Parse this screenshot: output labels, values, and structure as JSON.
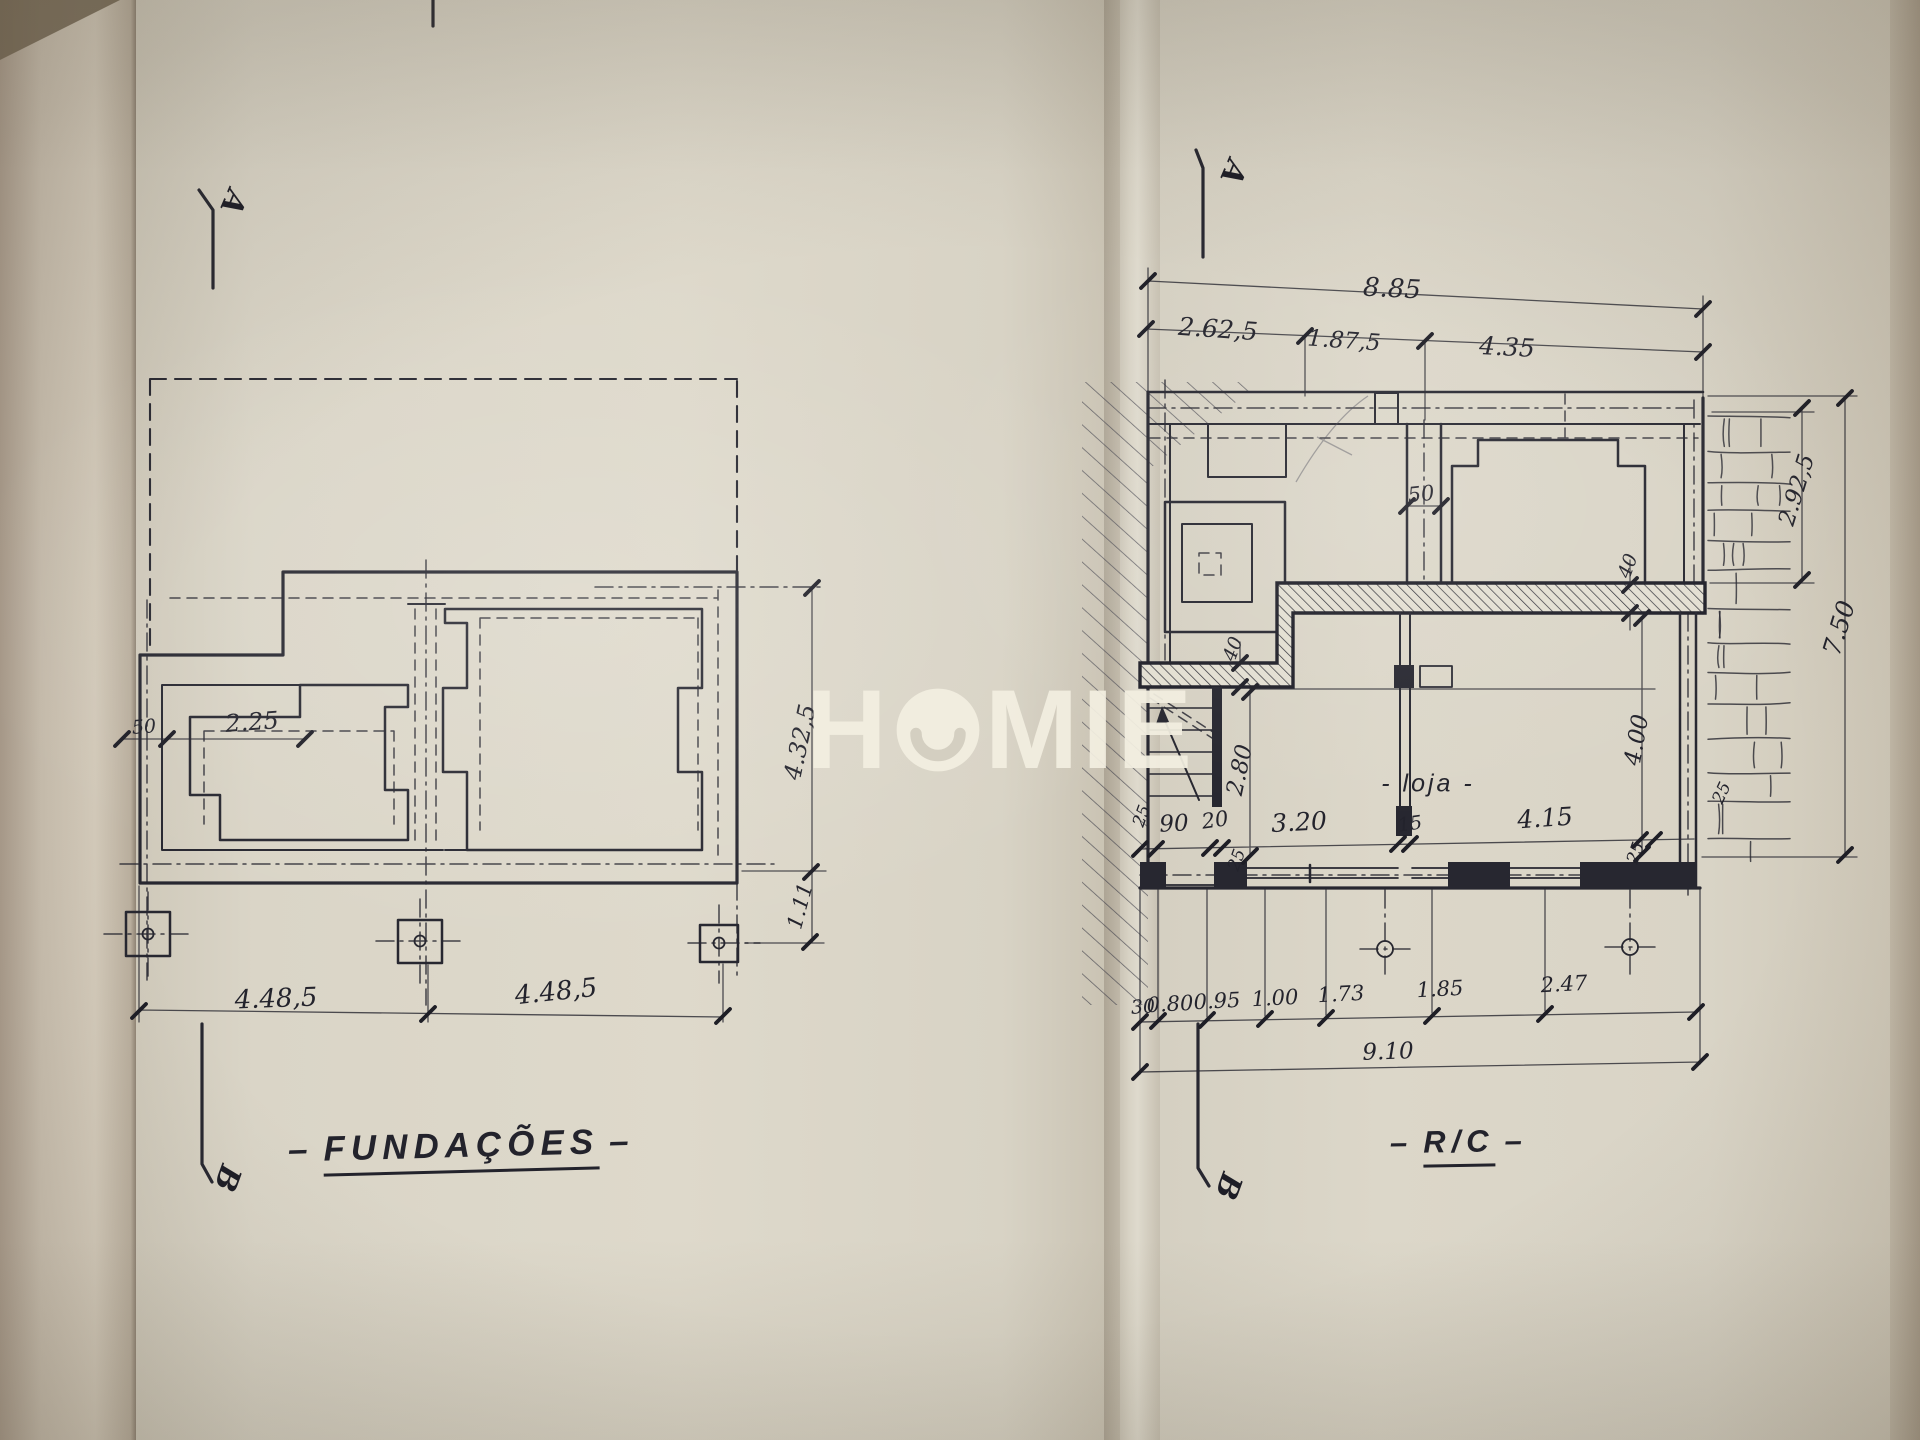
{
  "colors": {
    "paper": "#d7d2c4",
    "ink": "#272730",
    "watermark": "#f3efe1"
  },
  "watermark": {
    "text": "HOMIE",
    "left_part": "H",
    "right_part": "MIE",
    "o_glyph": "smiley-circle"
  },
  "foundations": {
    "title_dash_left": "–",
    "title": "FUNDAÇÕES",
    "title_dash_right": "–",
    "section_marker_top": "A",
    "section_marker_bottom": "B",
    "labels": [
      {
        "t": "50",
        "x": 144,
        "y": 727,
        "r": -4,
        "s": 19
      },
      {
        "t": "2.25",
        "x": 252,
        "y": 722,
        "r": -4,
        "s": 24
      },
      {
        "t": "4.32,5",
        "x": 800,
        "y": 742,
        "r": -78,
        "s": 24
      },
      {
        "t": "1.11",
        "x": 800,
        "y": 906,
        "r": -75,
        "s": 21
      },
      {
        "t": "4.48,5",
        "x": 276,
        "y": 999,
        "r": -2,
        "s": 26
      },
      {
        "t": "4.48,5",
        "x": 556,
        "y": 992,
        "r": -6,
        "s": 26
      }
    ]
  },
  "rc": {
    "title_dash_left": "–",
    "title": "R/C",
    "title_dash_right": "–",
    "section_marker_top": "A",
    "section_marker_bottom": "B",
    "room_label": "- loja -",
    "labels": [
      {
        "t": "8.85",
        "x": 1392,
        "y": 289,
        "r": 3,
        "s": 26
      },
      {
        "t": "2.62,5",
        "x": 1218,
        "y": 329,
        "r": 4,
        "s": 25
      },
      {
        "t": "1.87,5",
        "x": 1344,
        "y": 341,
        "r": 4,
        "s": 23
      },
      {
        "t": "4.35",
        "x": 1507,
        "y": 347,
        "r": 3,
        "s": 25
      },
      {
        "t": "2.92,5",
        "x": 1797,
        "y": 490,
        "r": -73,
        "s": 23
      },
      {
        "t": "7.50",
        "x": 1839,
        "y": 628,
        "r": -73,
        "s": 25
      },
      {
        "t": "25",
        "x": 1722,
        "y": 793,
        "r": -65,
        "s": 17
      },
      {
        "t": "50",
        "x": 1421,
        "y": 494,
        "r": -6,
        "s": 21
      },
      {
        "t": "40",
        "x": 1628,
        "y": 566,
        "r": -70,
        "s": 19
      },
      {
        "t": "40",
        "x": 1233,
        "y": 649,
        "r": -70,
        "s": 19
      },
      {
        "t": "2.80",
        "x": 1240,
        "y": 770,
        "r": -78,
        "s": 23
      },
      {
        "t": "4.00",
        "x": 1637,
        "y": 740,
        "r": -80,
        "s": 23
      },
      {
        "t": "25",
        "x": 1142,
        "y": 816,
        "r": -70,
        "s": 17
      },
      {
        "t": "90",
        "x": 1174,
        "y": 824,
        "r": -3,
        "s": 23
      },
      {
        "t": "20",
        "x": 1215,
        "y": 820,
        "r": -8,
        "s": 21
      },
      {
        "t": "3.20",
        "x": 1299,
        "y": 822,
        "r": -3,
        "s": 25
      },
      {
        "t": "15",
        "x": 1410,
        "y": 824,
        "r": -8,
        "s": 19
      },
      {
        "t": "4.15",
        "x": 1545,
        "y": 818,
        "r": -4,
        "s": 25
      },
      {
        "t": "25",
        "x": 1636,
        "y": 853,
        "r": -70,
        "s": 17
      },
      {
        "t": "25",
        "x": 1237,
        "y": 860,
        "r": -70,
        "s": 17
      },
      {
        "t": "30",
        "x": 1143,
        "y": 1007,
        "r": -4,
        "s": 19
      },
      {
        "t": "0.80",
        "x": 1170,
        "y": 1004,
        "r": -3,
        "s": 21
      },
      {
        "t": "0.95",
        "x": 1217,
        "y": 1001,
        "r": -3,
        "s": 21
      },
      {
        "t": "1.00",
        "x": 1275,
        "y": 998,
        "r": -3,
        "s": 21
      },
      {
        "t": "1.73",
        "x": 1341,
        "y": 994,
        "r": -3,
        "s": 21
      },
      {
        "t": "1.85",
        "x": 1440,
        "y": 989,
        "r": -3,
        "s": 21
      },
      {
        "t": "2.47",
        "x": 1564,
        "y": 984,
        "r": -3,
        "s": 21
      },
      {
        "t": "9.10",
        "x": 1388,
        "y": 1052,
        "r": -2,
        "s": 23
      }
    ]
  }
}
